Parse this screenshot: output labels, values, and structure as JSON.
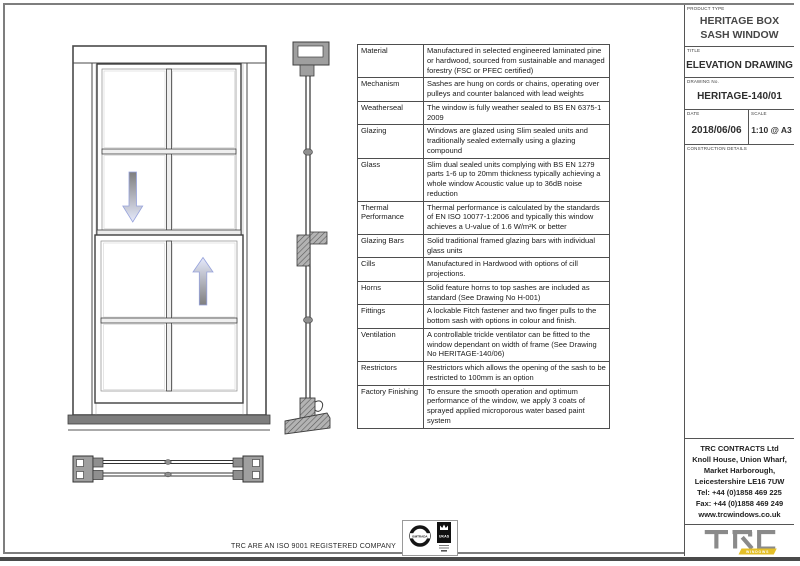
{
  "sheet": {
    "iso_statement": "TRC ARE AN ISO 9001 REGISTERED COMPANY"
  },
  "spec_table": {
    "rows": [
      {
        "label": "Material",
        "text": "Manufactured in selected engineered laminated pine or hardwood, sourced from sustainable and managed forestry (FSC or PFEC certified)"
      },
      {
        "label": "Mechanism",
        "text": "Sashes are hung on cords or chains, operating over pulleys and counter balanced with lead weights"
      },
      {
        "label": "Weatherseal",
        "text": "The window is fully weather sealed to BS EN 6375-1 2009"
      },
      {
        "label": "Glazing",
        "text": "Windows are glazed using Slim sealed units and traditionally sealed externally using a glazing compound"
      },
      {
        "label": "Glass",
        "text": "Slim dual sealed units complying with BS EN 1279 parts 1-6 up to 20mm thickness typically achieving a whole window Acoustic value up to 36dB noise reduction"
      },
      {
        "label": "Thermal Performance",
        "text": "Thermal performance is calculated by the standards of EN ISO 10077-1:2006 and typically this window achieves a U-value of 1.6 W/m²K or better"
      },
      {
        "label": "Glazing Bars",
        "text": "Solid traditional framed glazing bars with individual glass units"
      },
      {
        "label": "Cills",
        "text": "Manufactured in Hardwood with options of cill projections."
      },
      {
        "label": "Horns",
        "text": "Solid feature horns to top sashes are included as standard (See Drawing No H-001)"
      },
      {
        "label": "Fittings",
        "text": "A lockable Fitch fastener and two finger pulls to the bottom sash with options in colour and finish."
      },
      {
        "label": "Ventilation",
        "text": "A controllable trickle ventilator can be fitted to the window dependant on width of frame (See Drawing No HERITAGE-140/06)"
      },
      {
        "label": "Restrictors",
        "text": "Restrictors which allows the opening of the sash to be restricted to 100mm is an option"
      },
      {
        "label": "Factory Finishing",
        "text": "To ensure the smooth operation and optimum performance of the window, we apply 3 coats of sprayed applied microporous water based paint system"
      }
    ]
  },
  "title_block": {
    "product_type_label": "PRODUCT TYPE",
    "product_type": "HERITAGE BOX SASH WINDOW",
    "title_label": "TITLE",
    "title": "ELEVATION DRAWING",
    "drawing_no_label": "DRAWING No.",
    "drawing_no": "HERITAGE-140/01",
    "date_label": "DATE",
    "date": "2018/06/06",
    "scale_label": "SCALE",
    "scale": "1:10 @ A3",
    "construction_label": "CONSTRUCTION DETAILS"
  },
  "contact": {
    "lines": [
      "TRC CONTRACTS Ltd",
      "Knoll House, Union Wharf,",
      "Market Harborough,",
      "Leicestershire LE16 7UW",
      "Tel: +44 (0)1858 469 225",
      "Fax: +44 (0)1858 469 249",
      "www.trcwindows.co.uk"
    ]
  },
  "logo": {
    "text": "TRC",
    "badge": "WINDOWS"
  },
  "certs": {
    "left": "BMTRADA",
    "right": "UKAS"
  },
  "colors": {
    "logo_gray": "#8a8a8a",
    "logo_yellow": "#e4bf28",
    "arrow_outline": "#97a3dc",
    "border_gray": "#7e7e7e"
  }
}
